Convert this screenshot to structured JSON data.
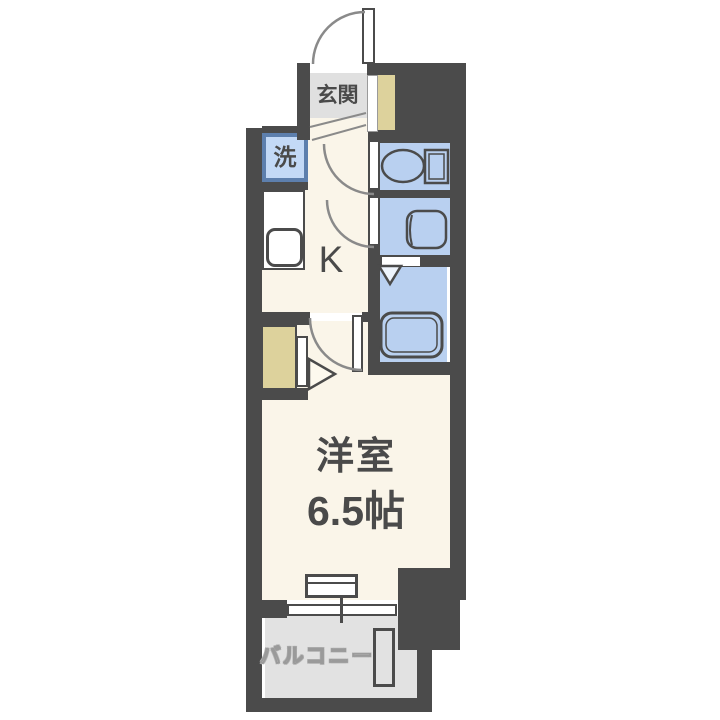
{
  "floorplan": {
    "type": "japanese-apartment-1K-floorplan",
    "labels": {
      "entrance": "玄関",
      "washer": "洗",
      "kitchen": "K",
      "main_room_name": "洋室",
      "main_room_size": "6.5帖",
      "balcony": "バルコニー"
    },
    "icons": [
      "entrance-door-swing-arc",
      "toilet-icon",
      "washbasin-icon",
      "bathtub-icon",
      "kitchen-sink-icon",
      "folding-door-chevron",
      "door-swing-arc",
      "closet-door-triangle",
      "sliding-window",
      "balcony-unit"
    ],
    "colors": {
      "wall": "#4b4b4b",
      "room_floor": "#faf5e9",
      "wet_area": "#b9d0f0",
      "washer_fill": "#c3d9f6",
      "washer_border": "#5d7fad",
      "closet": "#ddd29c",
      "entrance_floor": "#e0e0e0",
      "balcony_floor": "#e2e2e2",
      "arc_line": "#8a8a8a",
      "text": "#4a4a4a"
    }
  }
}
